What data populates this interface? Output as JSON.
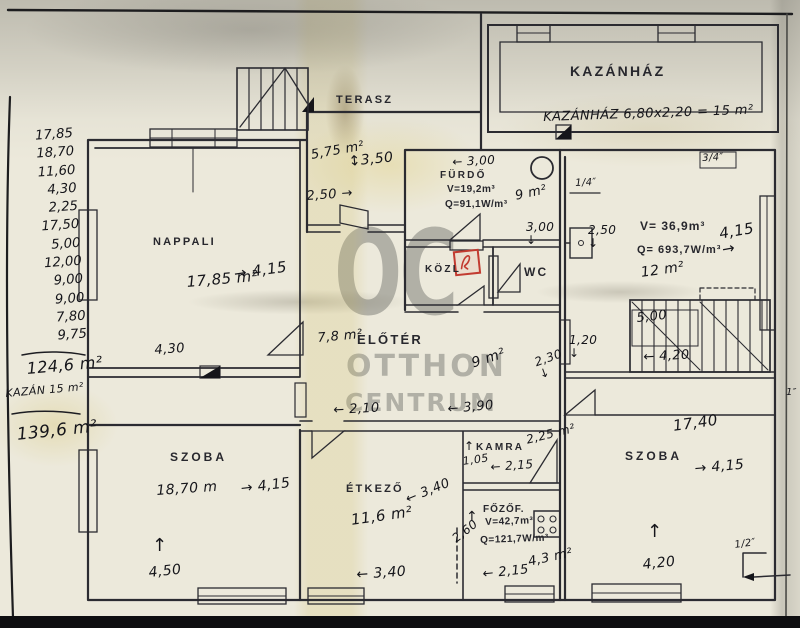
{
  "watermark": {
    "monogram": "OC",
    "line1": "OTTHON",
    "line2": "CENTRUM"
  },
  "margin_calc": {
    "values": [
      "17,85",
      "18,70",
      "11,60",
      "4,30",
      "2,25",
      "17,50",
      "5,00",
      "12,00",
      "9,00",
      "9,00",
      "7,80",
      "9,75"
    ],
    "subtotal": "124,6 m²",
    "kazan_note": "KAZÁN 15 m²",
    "total": "139,6 m²"
  },
  "kazanhaz": {
    "name": "KAZÁNHÁZ",
    "note": "KAZÁNHÁZ 6,80x2,20 = 15 m²"
  },
  "terasz": {
    "name": "TERASZ",
    "area": "5,75 m²",
    "dim_height": "↕3,50",
    "dim_door": "2,50 →"
  },
  "nappali": {
    "name": "NAPPALI",
    "area": "17,85 m²",
    "dim_width": "→ 4,15",
    "dim_bottom": "4,30"
  },
  "furdo": {
    "name": "FÜRDŐ",
    "volume": "V=19,2m³",
    "heat": "Q=91,1W/m³",
    "dim_top": "← 3,00",
    "area": "9 m²",
    "dim_inner": "3,00\n↓"
  },
  "kozl": {
    "name": "KÖZL"
  },
  "wc": {
    "name": "WC"
  },
  "szoba_jobb_felso": {
    "volume": "V= 36,9m³",
    "heat": "Q= 693,7W/m³",
    "area": "12 m²",
    "dim_width": "4,15\n→",
    "dim_left": "2,50\n↓",
    "vent_top": "3/4″",
    "vent_left": "1/4″",
    "edge_dim": "1″"
  },
  "lepcso": {
    "dim_top": "5,00",
    "dim_bottom": "← 4,20",
    "dim_a": "1,20\n↓",
    "dim_b": "2,30\n↓"
  },
  "eloter": {
    "name": "ELŐTÉR",
    "area": "7,8 m²",
    "area_b": "9 m²",
    "dim_a": "← 2,10",
    "dim_b": "← 3,90"
  },
  "szoba_bal": {
    "name": "SZOBA",
    "area": "18,70 m",
    "dim_width": "→ 4,15",
    "dim_bottom": "4,50",
    "arrow": "↑"
  },
  "etkezo": {
    "name": "ÉTKEZŐ",
    "area": "11,6 m²",
    "dim_right": "← 3,40",
    "dim_bottom": "← 3,40"
  },
  "kamra": {
    "name": "KAMRA",
    "arrow": "↑",
    "area": "2,25 m²",
    "dim_a": "1,05",
    "dim_b": "← 2,15"
  },
  "fozofulke": {
    "name": "FŐZŐF.",
    "volume": "V=42,7m³",
    "heat": "Q=121,7W/m³",
    "area": "4,3 m²",
    "dim_left": "2,60",
    "dim_bottom": "← 2,15",
    "arrow": "↑"
  },
  "szoba_jobb_also": {
    "name": "SZOBA",
    "area": "17,40",
    "dim_width": "→ 4,15",
    "dim_bottom": "4,20",
    "door_dim": "1/2″",
    "arrow": "↑"
  }
}
